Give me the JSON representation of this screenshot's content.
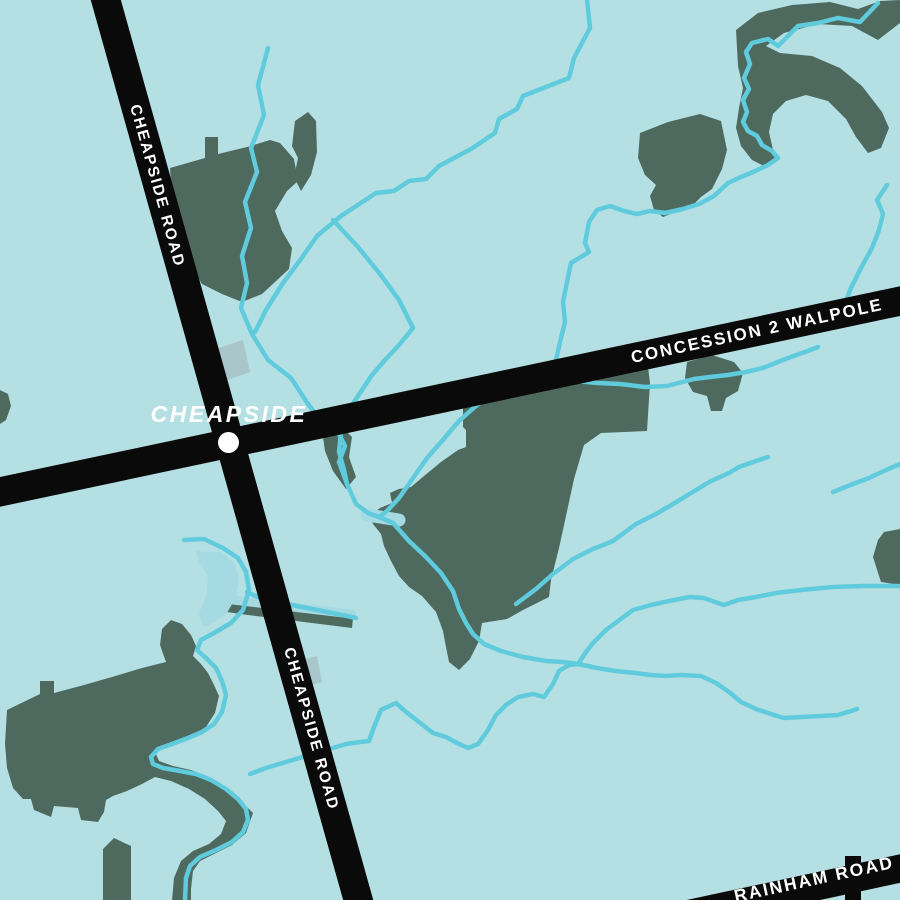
{
  "map": {
    "place": {
      "name": "CHEAPSIDE"
    },
    "roads": {
      "cheapside": "CHEAPSIDE ROAD",
      "concession": "CONCESSION 2 WALPOLE",
      "rainham": "RAINHAM ROAD"
    },
    "features": {
      "marker": "town-intersection-dot",
      "forest_patch_count": "12",
      "stream_network": "creek tributaries of Sandusk / Nanticoke area"
    },
    "colors": {
      "background": "#b5e0e3",
      "forest": "#4e6a5f",
      "water": "#5fcbdc",
      "waterwide": "#a6dae3",
      "road": "#0a0a0a",
      "label": "#ffffff",
      "built": "#a6bfc4"
    }
  }
}
